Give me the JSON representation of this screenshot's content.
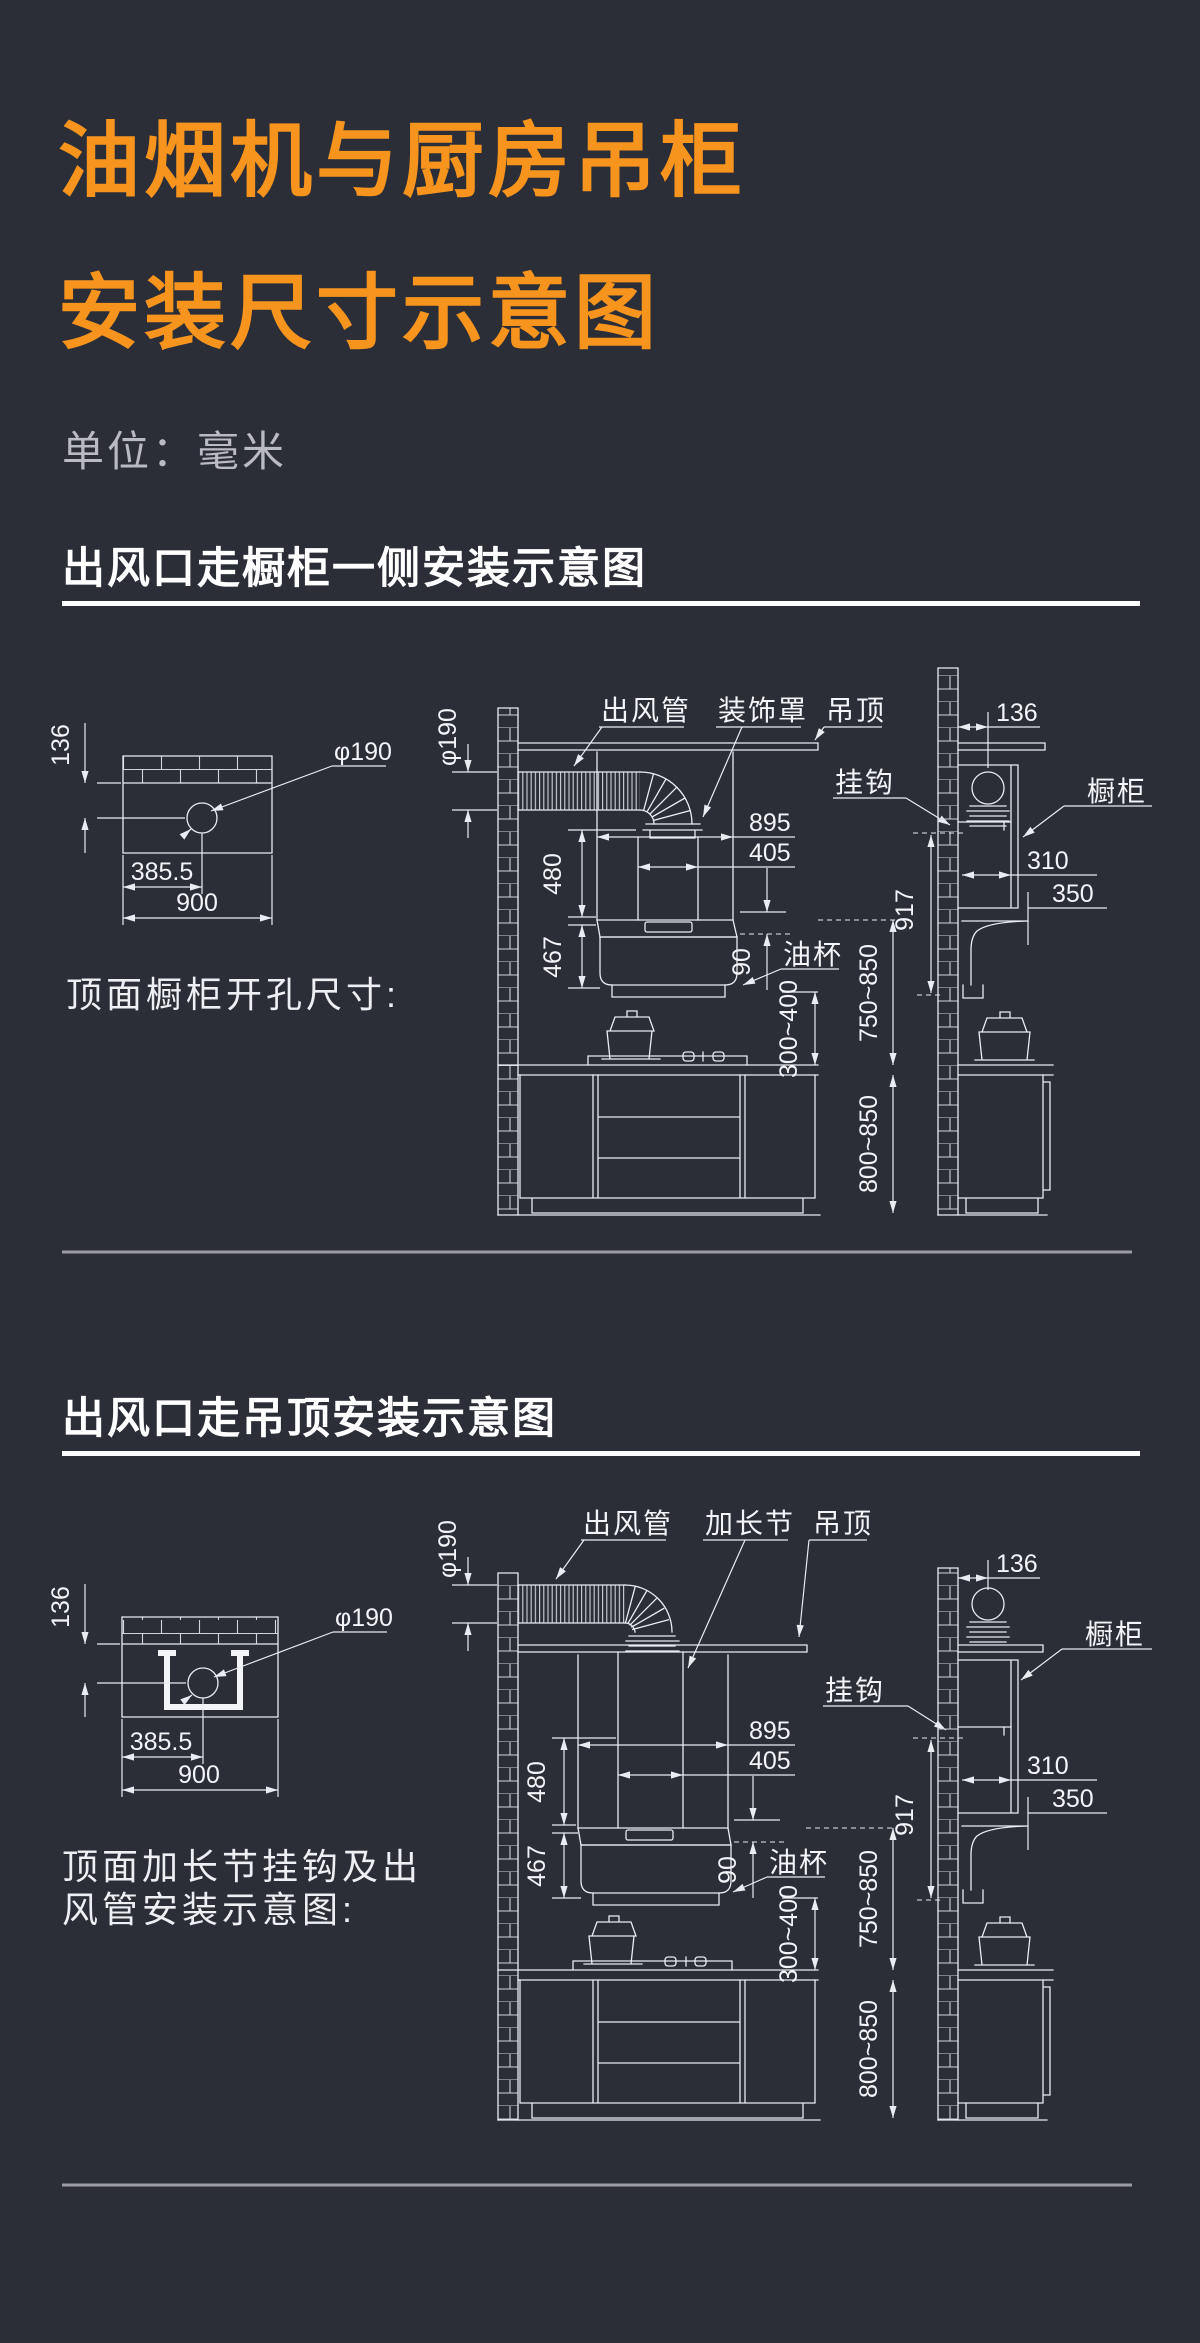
{
  "page": {
    "background": "#2b2d37",
    "accent_orange": "#f7941e",
    "line_color": "#e9ecf1",
    "divider_color": "#9b9ca3"
  },
  "header": {
    "title_line1": "油烟机与厨房吊柜",
    "title_line2": "安装尺寸示意图",
    "unit": "单位：毫米"
  },
  "section1": {
    "heading": "出风口走橱柜一侧安装示意图",
    "cutout": {
      "dim_edge": "136",
      "dim_center": "385.5",
      "dim_width": "900",
      "dim_hole": "φ190",
      "caption": "顶面橱柜开孔尺寸:"
    },
    "front": {
      "dim_duct": "φ190",
      "label_duct": "出风管",
      "label_cover": "装饰罩",
      "label_ceiling": "吊顶",
      "label_hook": "挂钩",
      "dim_hood_w": "895",
      "dim_outlet_w": "405",
      "dim_upper_h": "480",
      "dim_lower_h": "467",
      "dim_cup_h": "90",
      "label_cup": "油杯",
      "dim_clearance": "300~400",
      "dim_hood_height": "750~850",
      "dim_counter_h": "800~850"
    },
    "side": {
      "dim_wall_gap": "136",
      "label_cabinet": "橱柜",
      "dim_cab_depth": "310",
      "dim_hood_depth": "350",
      "dim_hook_h": "917"
    }
  },
  "section2": {
    "heading": "出风口走吊顶安装示意图",
    "cutout": {
      "dim_edge": "136",
      "dim_center": "385.5",
      "dim_width": "900",
      "dim_hole": "φ190",
      "caption_line1": "顶面加长节挂钩及出",
      "caption_line2": "风管安装示意图:"
    },
    "front": {
      "dim_duct": "φ190",
      "label_duct": "出风管",
      "label_ext": "加长节",
      "label_ceiling": "吊顶",
      "label_hook": "挂钩",
      "dim_hood_w": "895",
      "dim_outlet_w": "405",
      "dim_upper_h": "480",
      "dim_lower_h": "467",
      "dim_cup_h": "90",
      "label_cup": "油杯",
      "dim_clearance": "300~400",
      "dim_hood_height": "750~850",
      "dim_counter_h": "800~850"
    },
    "side": {
      "dim_wall_gap": "136",
      "label_cabinet": "橱柜",
      "dim_cab_depth": "310",
      "dim_hood_depth": "350",
      "dim_hook_h": "917"
    }
  }
}
